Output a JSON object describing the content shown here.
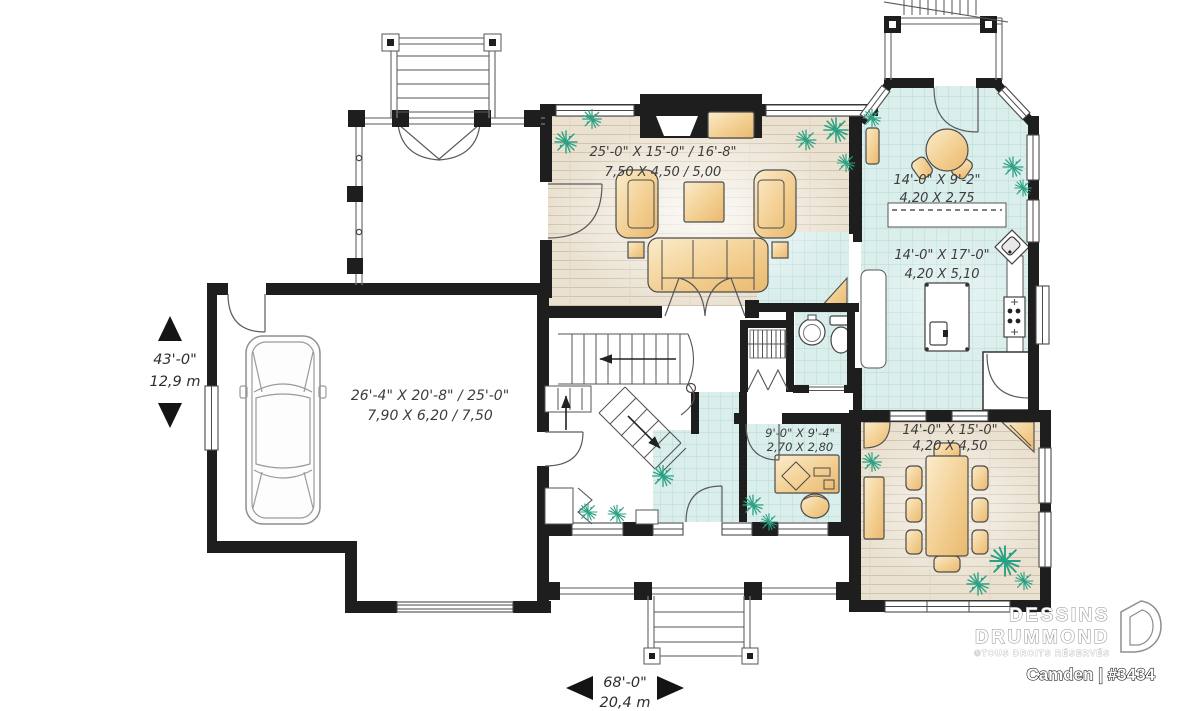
{
  "rooms": {
    "living": {
      "imperial": "25'-0\" X 15'-0\" / 16'-8\"",
      "metric": "7,50 X 4,50 / 5,00"
    },
    "breakfast": {
      "imperial": "14'-0\" X 9'-2\"",
      "metric": "4,20 X 2,75"
    },
    "kitchen": {
      "imperial": "14'-0\" X 17'-0\"",
      "metric": "4,20 X 5,10"
    },
    "garage": {
      "imperial": "26'-4\" X 20'-8\" / 25'-0\"",
      "metric": "7,90 X 6,20 / 7,50"
    },
    "office": {
      "imperial": "9'-0\" X 9'-4\"",
      "metric": "2,70 X 2,80"
    },
    "dining": {
      "imperial": "14'-0\" X 15'-0\"",
      "metric": "4,20 X 4,50"
    }
  },
  "dimensions": {
    "height": {
      "imperial": "43'-0\"",
      "metric": "12,9 m"
    },
    "width": {
      "imperial": "68'-0\"",
      "metric": "20,4 m"
    }
  },
  "branding": {
    "name_line1": "DESSINS",
    "name_line2": "DRUMMOND",
    "rights": "©TOUS DROITS RÉSERVÉS",
    "plan": "Camden | #3434"
  },
  "colors": {
    "wall": "#1e1e1e",
    "wood_floor": "#eae1d1",
    "tile_floor": "#daeeec",
    "furniture": "#f3cf92",
    "plant_green": "#2aa183"
  }
}
